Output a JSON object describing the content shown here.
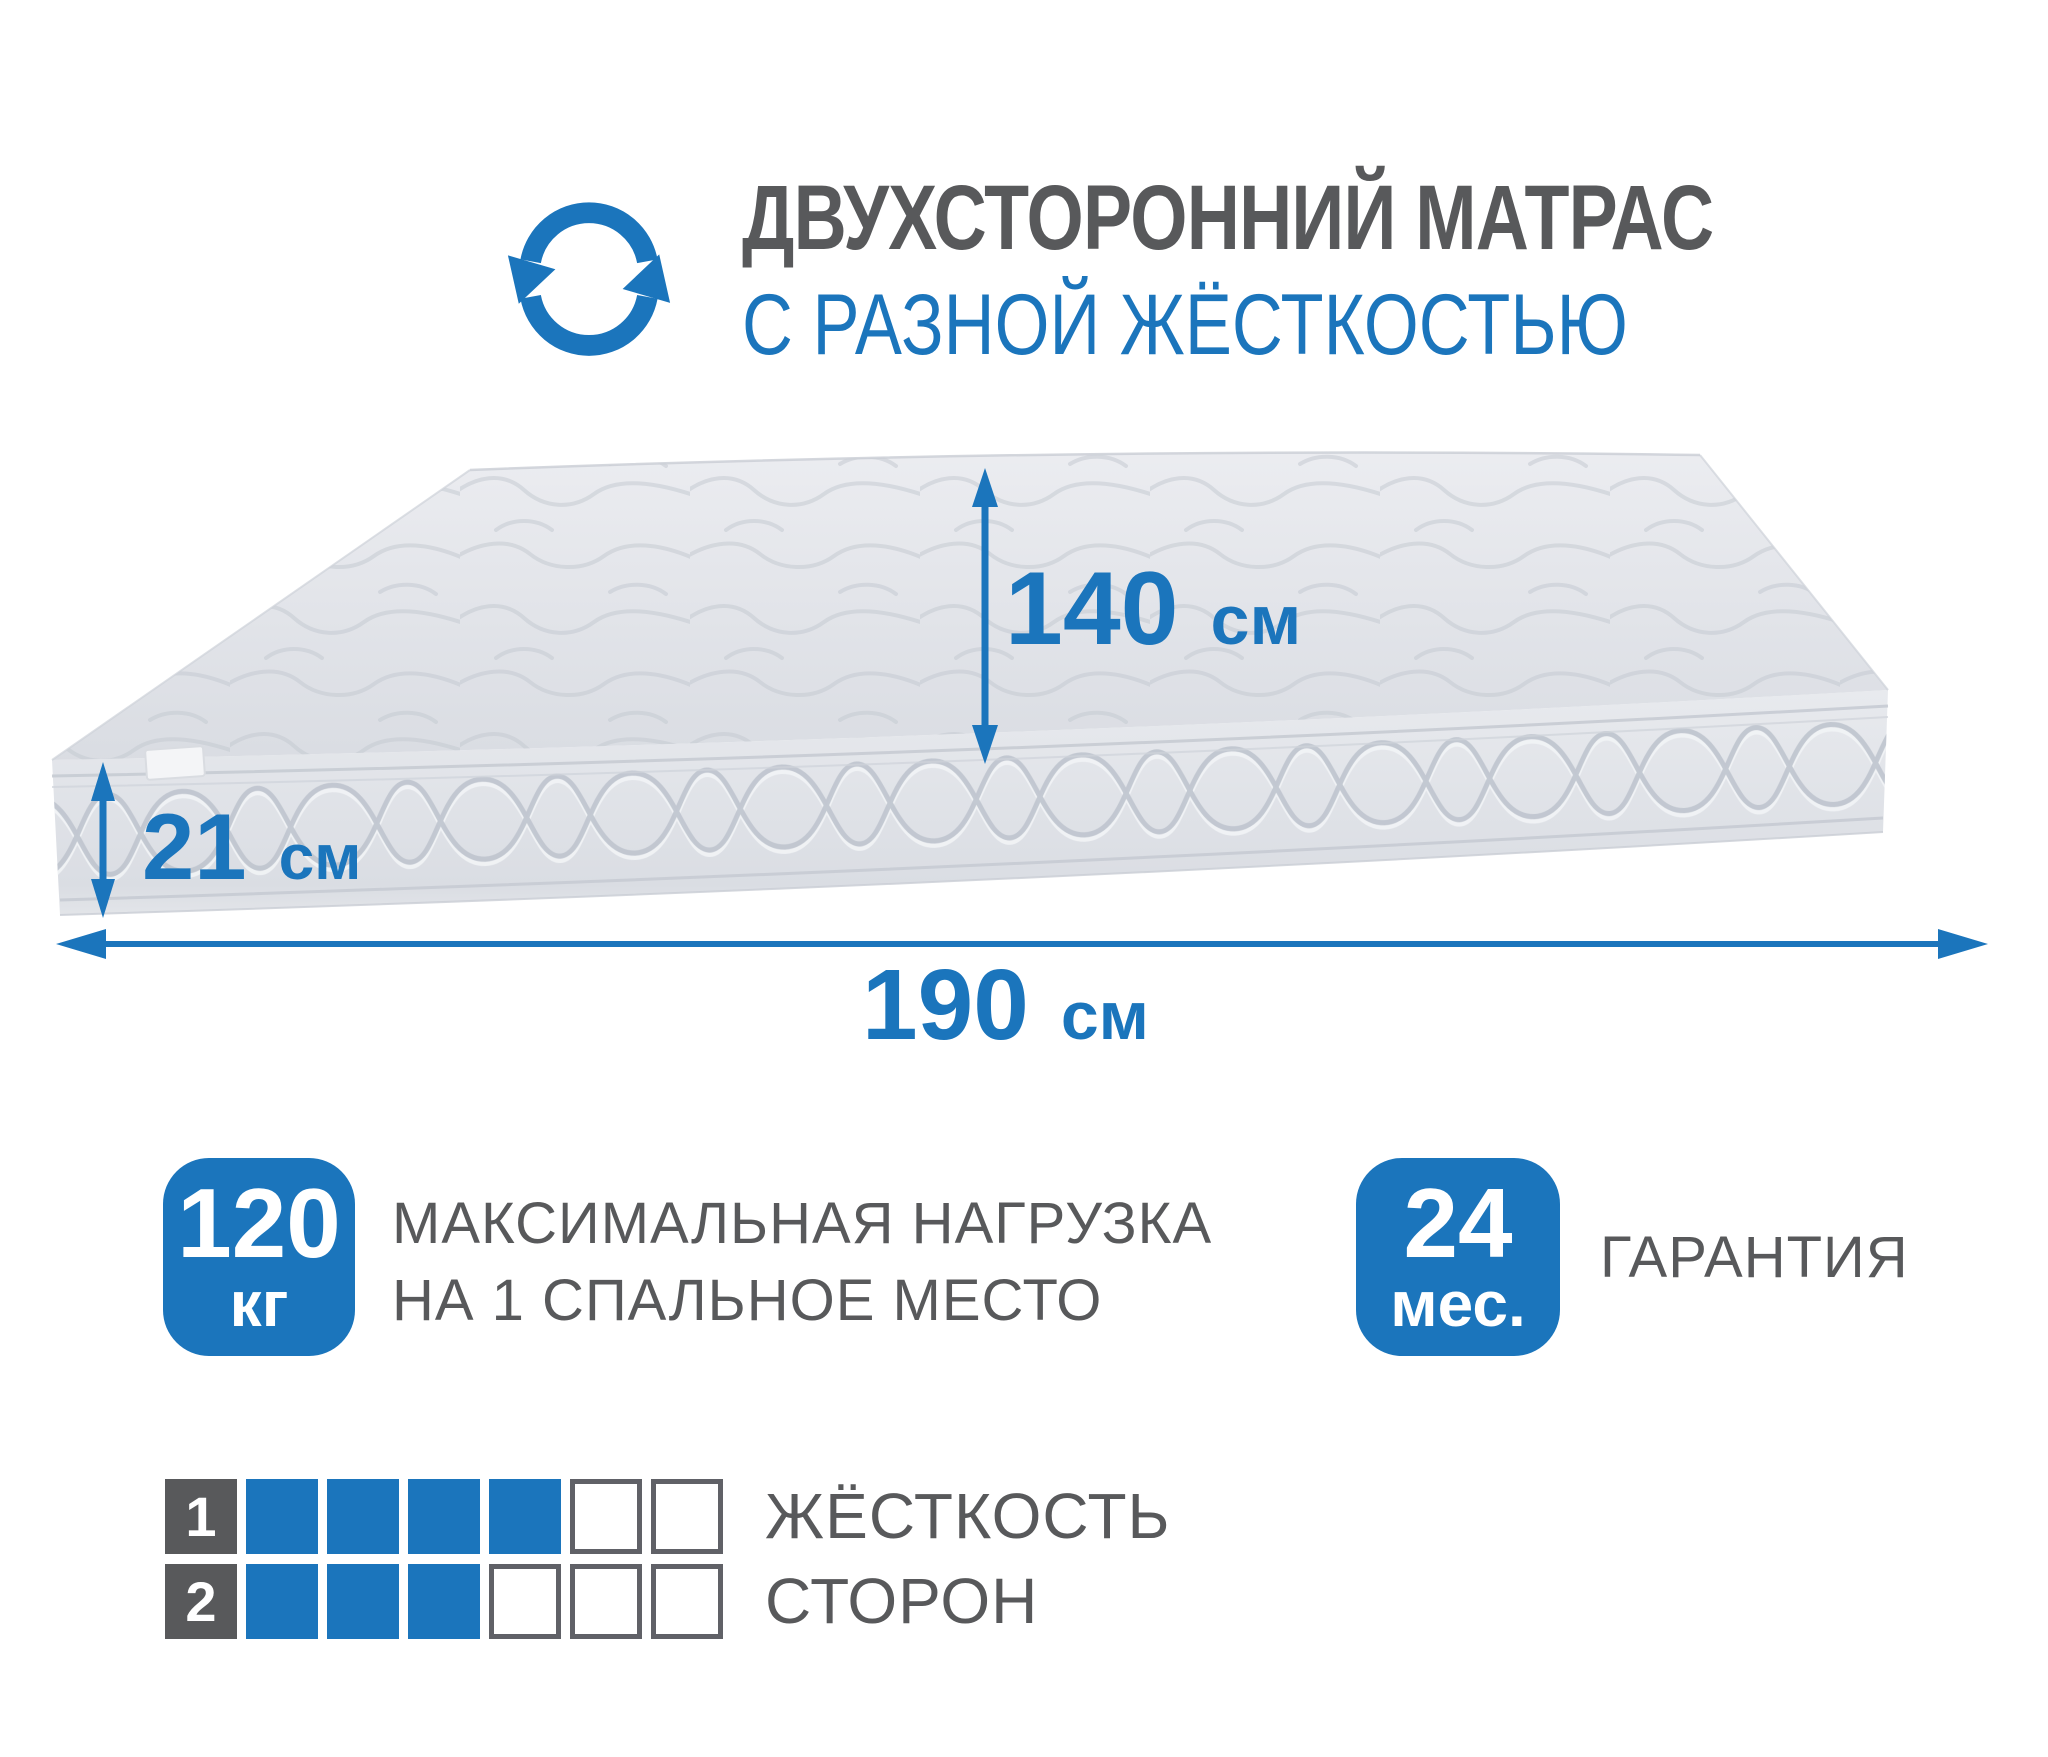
{
  "colors": {
    "accent_blue": "#1b75bc",
    "text_gray": "#58595b"
  },
  "header": {
    "icon": "rotate-arrows",
    "title_line1": "ДВУХСТОРОННИЙ МАТРАС",
    "title_line2": "С РАЗНОЙ ЖЁСТКОСТЬЮ"
  },
  "dimensions": {
    "width": {
      "value": "140",
      "unit": "см"
    },
    "height": {
      "value": "21",
      "unit": "см"
    },
    "length": {
      "value": "190",
      "unit": "см"
    }
  },
  "features": [
    {
      "badge_value": "120",
      "badge_unit": "кг",
      "label_line1": "МАКСИМАЛЬНАЯ НАГРУЗКА",
      "label_line2": "НА 1 СПАЛЬНОЕ МЕСТО"
    },
    {
      "badge_value": "24",
      "badge_unit": "мес.",
      "label_line1": "ГАРАНТИЯ",
      "label_line2": ""
    }
  ],
  "firmness": {
    "label_line1": "ЖЁСТКОСТЬ",
    "label_line2": "СТОРОН",
    "scale_max": 6,
    "rows": [
      {
        "side": "1",
        "filled": 4
      },
      {
        "side": "2",
        "filled": 3
      }
    ]
  }
}
